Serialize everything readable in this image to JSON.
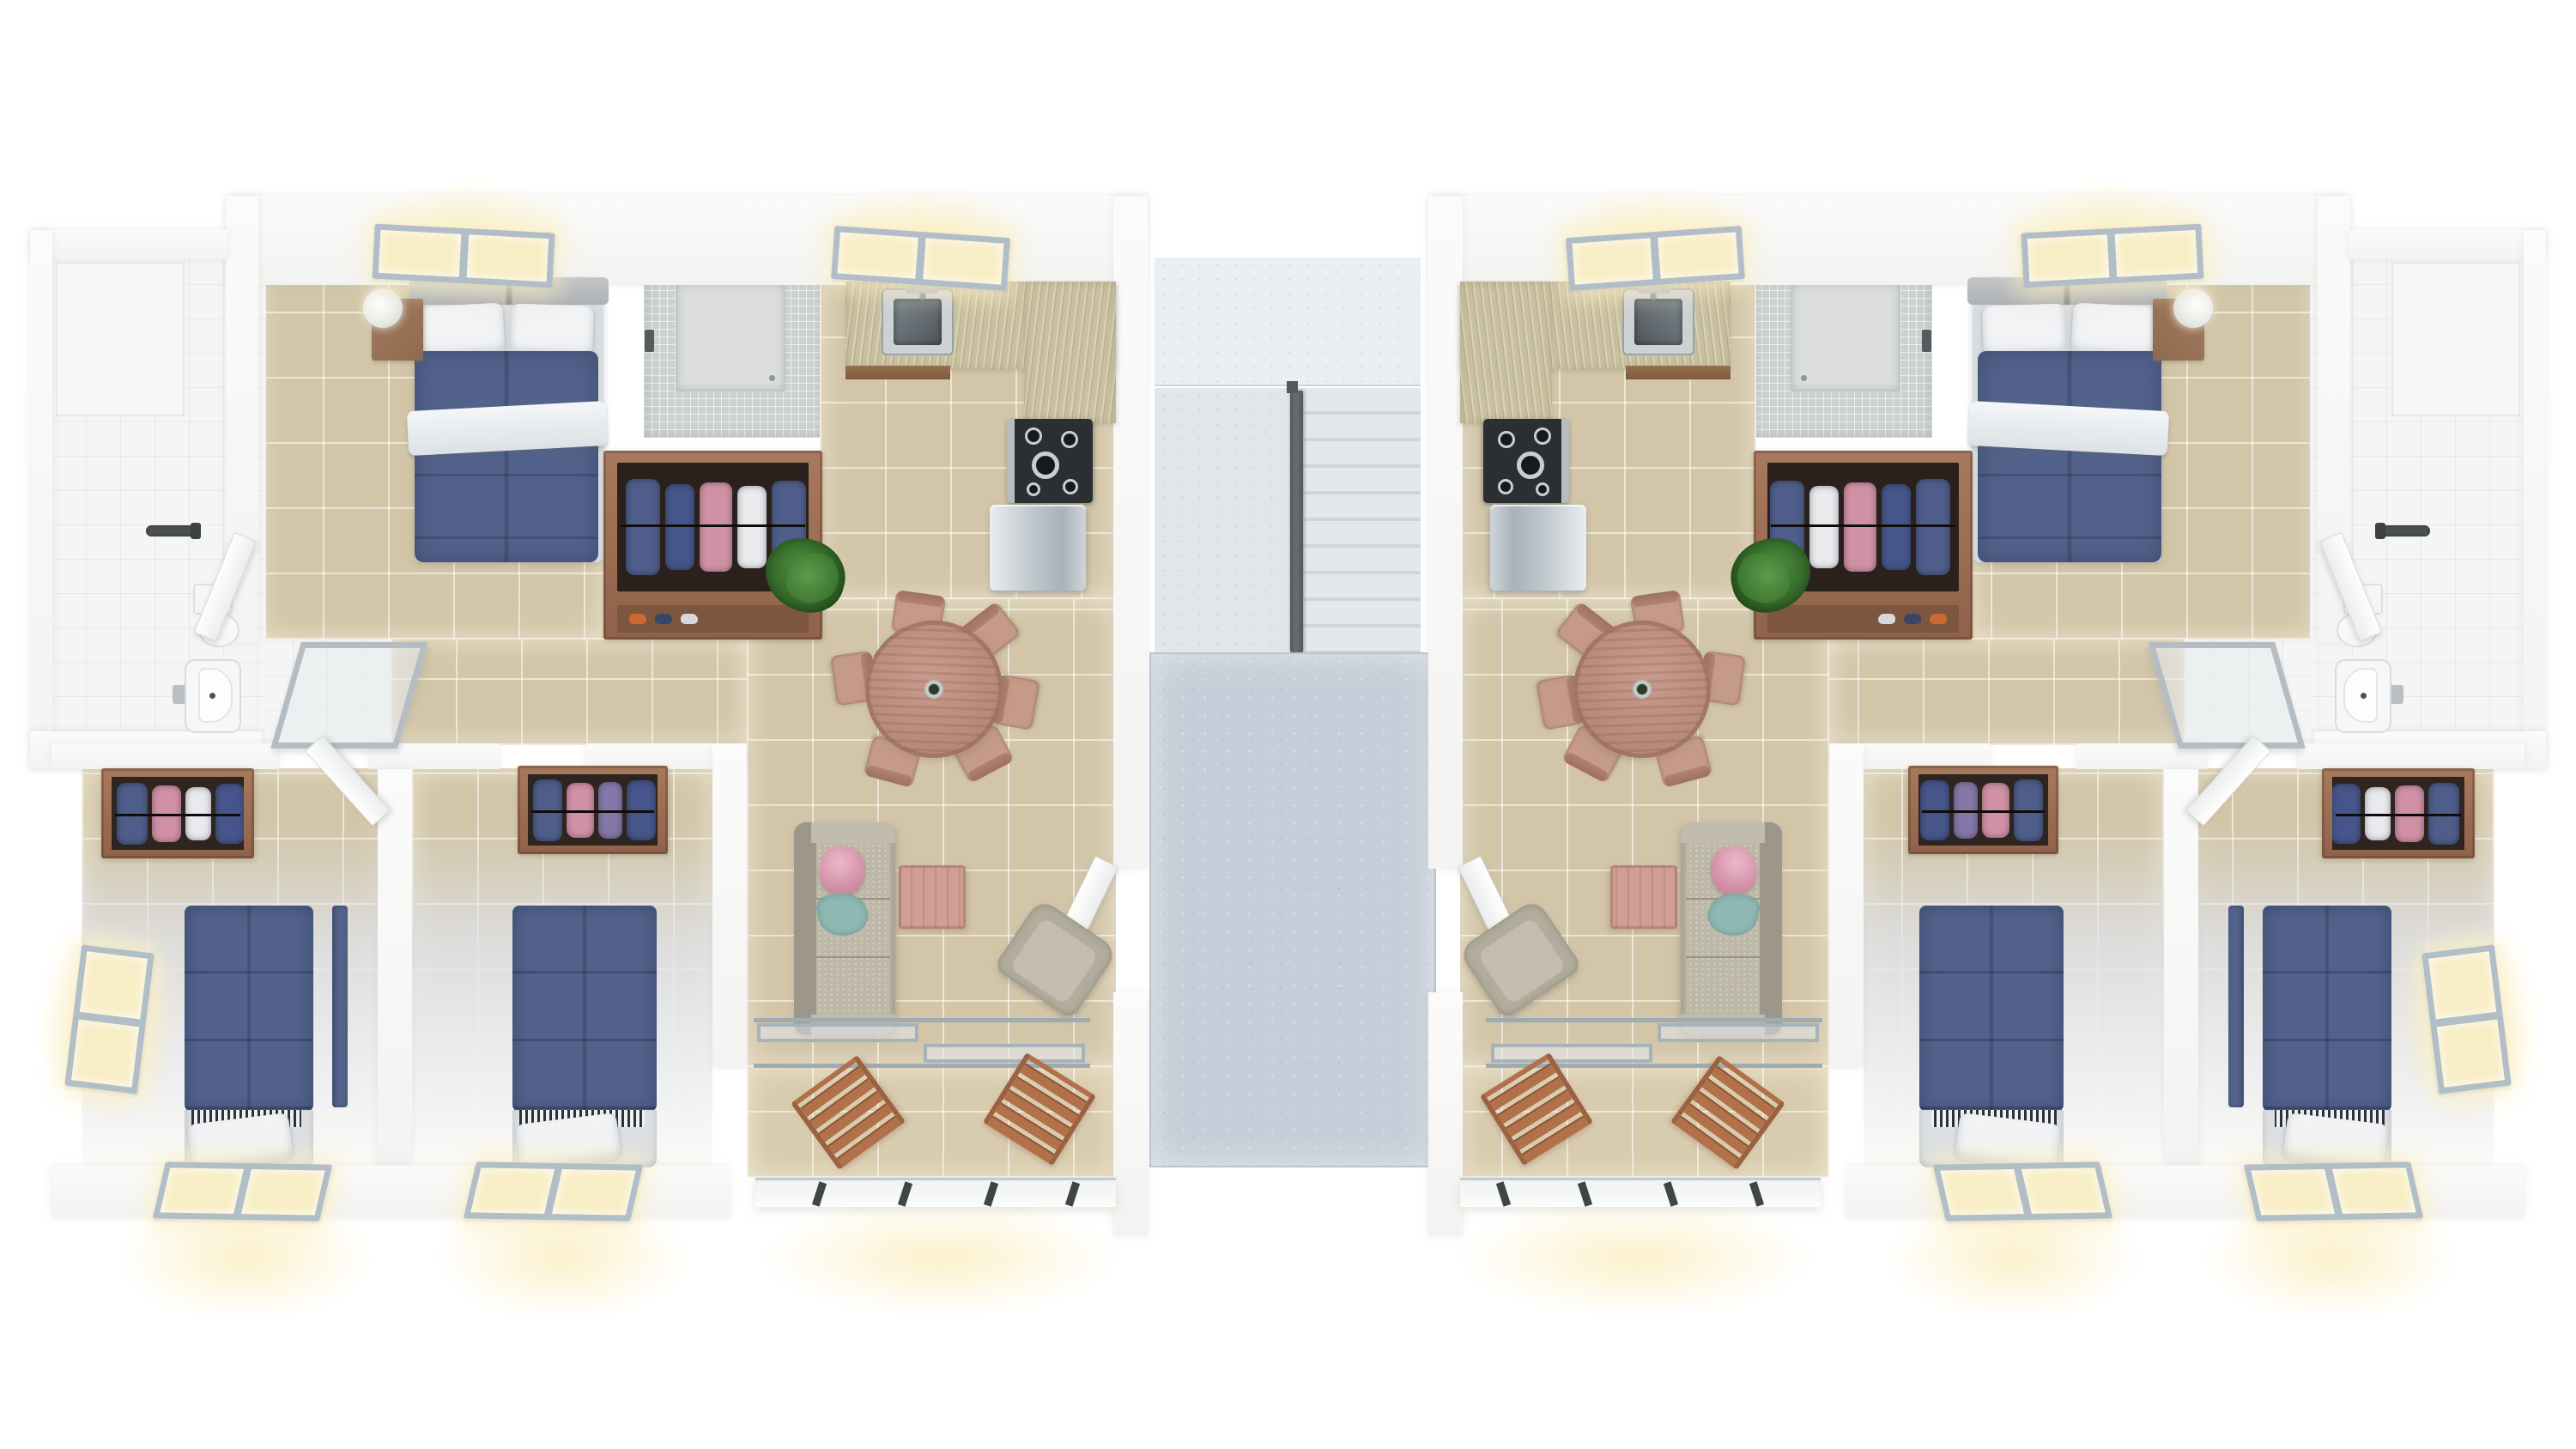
{
  "scene": {
    "title": "3D top-down floor plan render: two mirrored apartment units with central staircase",
    "type": "architectural-render",
    "units_count": 2,
    "mirrored": true,
    "bedrooms_per_unit": 3,
    "bathrooms_per_unit": 1,
    "background": "#ffffff"
  },
  "units": {
    "left": {
      "label": "Apartment unit A (left)"
    },
    "right": {
      "label": "Apartment unit B (right, mirrored)"
    }
  },
  "rooms": {
    "master_bedroom": "Master bedroom with double bed",
    "ensuite_shower": "Mosaic-tiled shower",
    "wardrobe": "Wardrobe closet with hanging clothes",
    "kitchen": "Kitchen with L-shaped counter",
    "living_dining": "Living and dining room",
    "hallway": "Hallway",
    "bathroom": "Bathroom with toilet and sink",
    "bedroom_a": "Corner bedroom with single beds",
    "bedroom_b": "Middle bedroom with single bed",
    "balcony": "Balcony with deck chairs",
    "stair_hall": "Central staircase",
    "landing": "Concrete entry landing"
  },
  "furniture": {
    "double_bed": "Double bed with blue duvet",
    "single_bed": "Single bed with blue duvet",
    "pillow": "Pillow",
    "nightstand": "Wooden nightstand",
    "lamp": "Table lamp",
    "clothes": "Hanging clothes",
    "shower_zone": "Shower area",
    "shower_head": "Shower head",
    "toilet": "Toilet",
    "sink": "Bathroom sink",
    "kitchen_sink": "Stainless kitchen sink",
    "stove": "Gas stove",
    "fridge": "Refrigerator",
    "counter": "Stone kitchen counter",
    "dining_table": "Round wooden dining table",
    "dining_chair": "Wooden dining chair",
    "plant": "Potted plant",
    "sofa": "Fabric sofa with floral pillow",
    "coffee_table": "Wooden coffee table",
    "armchair": "Armchair",
    "door": "Interior door",
    "glass_door": "Glass bathroom door",
    "entry_door": "Entry door to landing",
    "window": "Window (lit)",
    "sliding_door": "Sliding glass balcony door",
    "deck_chair": "Wooden slatted deck chair",
    "balcony_railing": "Balcony railing",
    "stairs": "Concrete stair flight",
    "stair_railing": "Dark stair railing",
    "landing_slab": "Concrete landing slab"
  },
  "palette": {
    "tile": "#d2c5a8",
    "landing_tan": "#d8cbae",
    "bath": "#f4f5f4",
    "mosaic": "#ccd1d0",
    "frame": "#b2bec7",
    "pane": "#f8eec6",
    "glow": "rgba(252,240,199,0.9)",
    "duvet": "#52628a",
    "pillow": "#f1f3f5",
    "counter": "#c9c09f",
    "stove": "#2c2f31",
    "sofa": "#b6b0a1",
    "sofa_dark": "#9c978a",
    "sofa_seat": "#beb8a9",
    "pink_pillow": "#cf8aa4",
    "teal": "#8fb8b2",
    "pinkwood": "#cf9f93",
    "chair_seat": "#c59a88",
    "chair_back": "#b08270",
    "deck_wood": "#b0714b",
    "closet_interior": "#2b211c",
    "plant_dark": "#2c5a22",
    "slab": "#c6cfd9",
    "step": "#cfd5d9",
    "post": "#3f4547"
  }
}
